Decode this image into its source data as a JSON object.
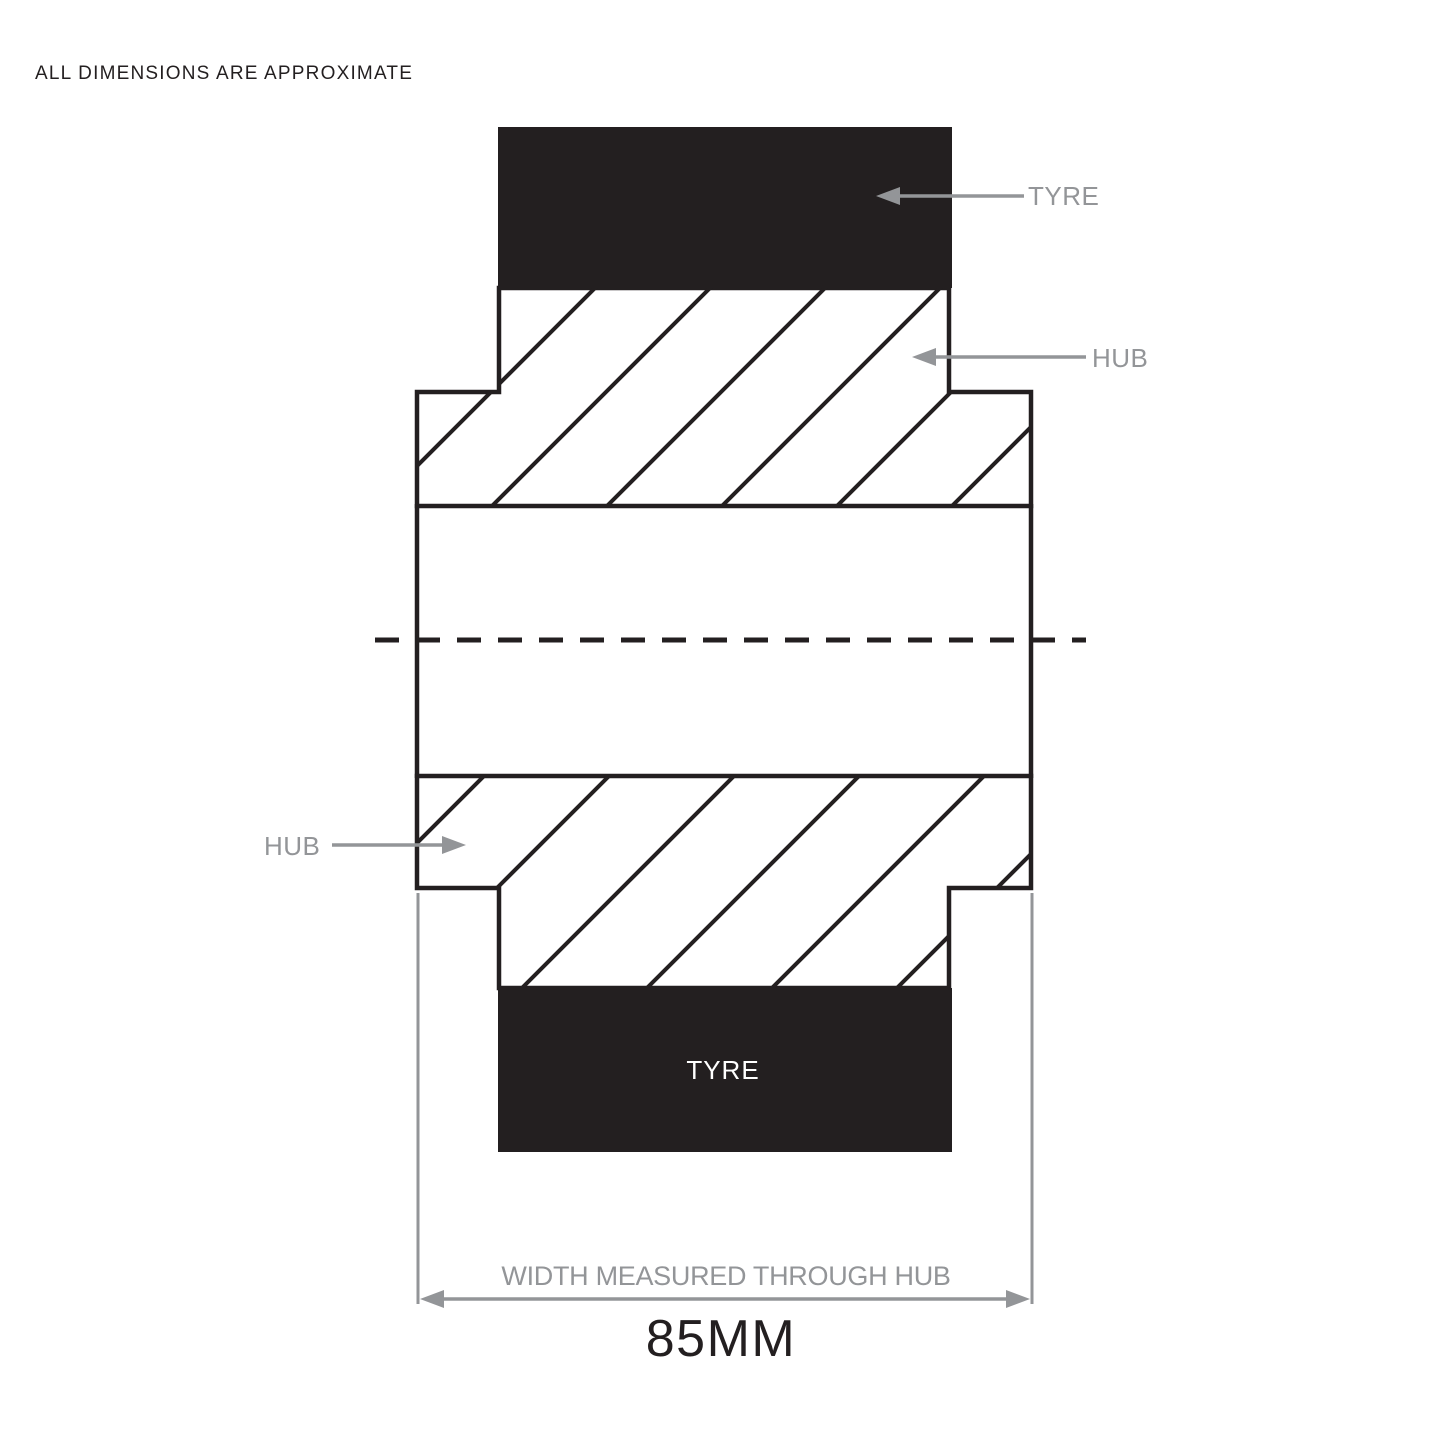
{
  "title": "ALL DIMENSIONS ARE APPROXIMATE",
  "annotations": {
    "tyre_top_label": "TYRE",
    "hub_right_label": "HUB",
    "hub_left_label": "HUB",
    "tyre_bottom_label": "TYRE"
  },
  "dimension": {
    "caption": "WIDTH MEASURED THROUGH HUB",
    "value": "85MM"
  },
  "colors": {
    "ink": "#231f20",
    "annotation_gray": "#939598",
    "background": "#ffffff"
  }
}
